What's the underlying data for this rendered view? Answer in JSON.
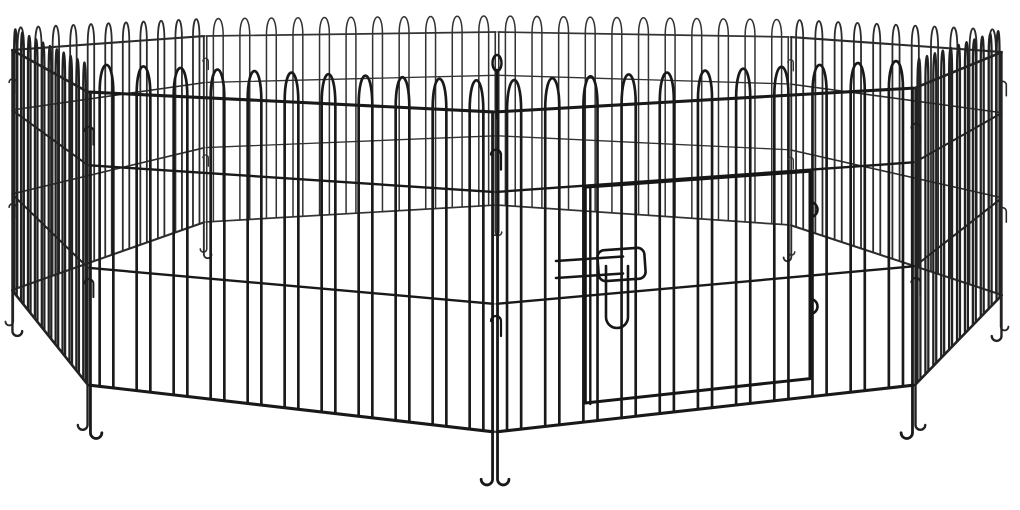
{
  "scene": {
    "description": "Studio product photo of an empty 8-panel black metal wire pet playpen (exercise pen) arranged in an octagon on a plain white background, viewed from a high front angle",
    "object": "pet-playpen",
    "style": "wire fence panels with arched hairpin loop tops",
    "background_color": "#ffffff",
    "panel_count": 8,
    "loops_per_panel": 11,
    "rails_per_panel": 4,
    "rail_positions": [
      1.0,
      0.75,
      0.4,
      0.0
    ],
    "door": {
      "present": true,
      "position": "front-right panel",
      "latch": "sliding wire drop-latch",
      "hinge_count": 2
    },
    "connectors": "J-shaped wire hooks at panel corners",
    "feet": "ground anchor feet at panel edge wires",
    "colors": {
      "wire_front": "#161616",
      "wire_back": "#3c3c3c",
      "background": "#ffffff"
    }
  }
}
